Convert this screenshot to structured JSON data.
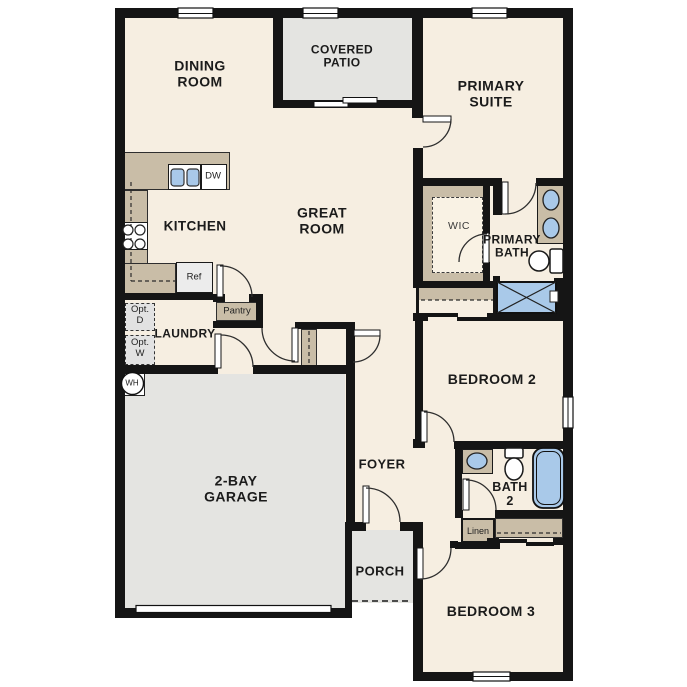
{
  "title": "Single-story floor plan",
  "colors": {
    "wall": "#151515",
    "floor": "#f6eee1",
    "concrete": "#e4e4e1",
    "cabinetry": "#c9bda7",
    "fixture_blue": "#a9c9e9"
  },
  "rooms": {
    "dining": {
      "line1": "DINING",
      "line2": "ROOM"
    },
    "patio": {
      "line1": "COVERED",
      "line2": "PATIO"
    },
    "suite": {
      "line1": "PRIMARY",
      "line2": "SUITE"
    },
    "great": {
      "line1": "GREAT",
      "line2": "ROOM"
    },
    "kitchen": {
      "label": "KITCHEN"
    },
    "wic": {
      "label": "WIC"
    },
    "pbath": {
      "line1": "PRIMARY",
      "line2": "BATH"
    },
    "laundry": {
      "label": "LAUNDRY"
    },
    "bed2": {
      "label": "BEDROOM 2"
    },
    "foyer": {
      "label": "FOYER"
    },
    "bath2": {
      "line1": "BATH",
      "line2": "2"
    },
    "porch": {
      "label": "PORCH"
    },
    "bed3": {
      "label": "BEDROOM 3"
    },
    "garage": {
      "line1": "2-BAY",
      "line2": "GARAGE"
    }
  },
  "fixtures": {
    "pantry": "Pantry",
    "ref": "Ref",
    "dw": "DW",
    "opt_d_line1": "Opt.",
    "opt_d_line2": "D",
    "opt_w_line1": "Opt.",
    "opt_w_line2": "W",
    "wh": "WH",
    "linen": "Linen"
  }
}
